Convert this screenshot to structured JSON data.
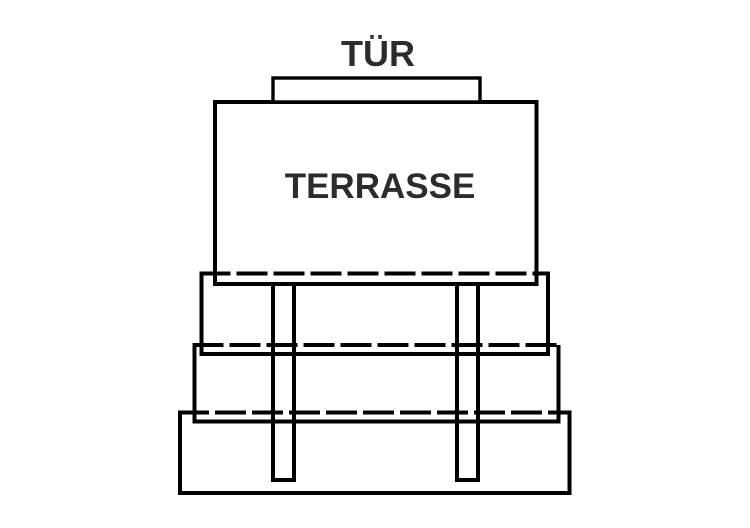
{
  "diagram": {
    "type": "terrace-stairs-plan",
    "labels": {
      "door": "TÜR",
      "terrace": "TERRASSE"
    },
    "colors": {
      "background": "#ffffff",
      "line": "#000000",
      "shape_fill": "#ffffff",
      "text": "#2c2c2c"
    },
    "steps_count": 3,
    "posts_count": 2
  }
}
